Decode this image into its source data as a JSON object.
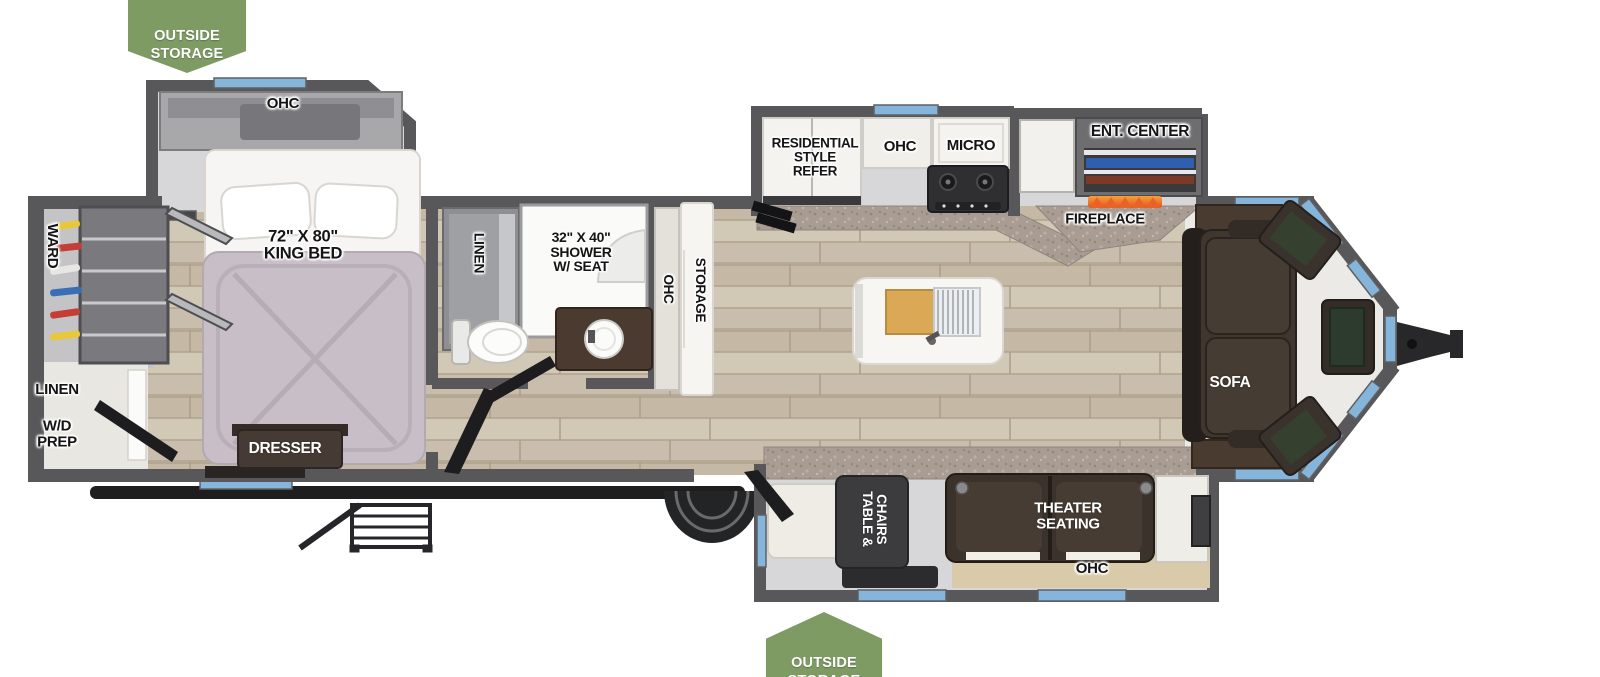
{
  "callouts": {
    "top_outside_storage": "OUTSIDE\nSTORAGE",
    "bottom_outside_storage": "OUTSIDE\nSTORAGE"
  },
  "labels": {
    "bedroom_ohc": "OHC",
    "king_bed": "72\" X 80\"\nKING BED",
    "ward": "WARD",
    "rear_linen": "LINEN",
    "wd_prep": "W/D\nPREP",
    "dresser": "DRESSER",
    "bath_linen": "LINEN",
    "shower": "32\" X 40\"\nSHOWER\nW/ SEAT",
    "hall_ohc": "OHC",
    "hall_storage": "STORAGE",
    "refrigerator": "RESIDENTIAL\nSTYLE\nREFER",
    "kitchen_ohc": "OHC",
    "micro": "MICRO",
    "ent_center": "ENT. CENTER",
    "fireplace": "FIREPLACE",
    "sofa": "SOFA",
    "table_chairs": "TABLE &\nCHAIRS",
    "theater_seating": "THEATER\nSEATING",
    "living_ohc": "OHC"
  },
  "colors": {
    "callout_green": "#7e9b64",
    "window_blue": "#85b5da",
    "wall_gray": "#58585b",
    "floor_wood": "#ccc1ae",
    "counter_granite": "#a89c93",
    "furniture_dark": "#3f372f",
    "bed_fabric": "#c7bec7",
    "cabinet_white": "#f4f3ef",
    "flame_orange": "#e8622a"
  }
}
